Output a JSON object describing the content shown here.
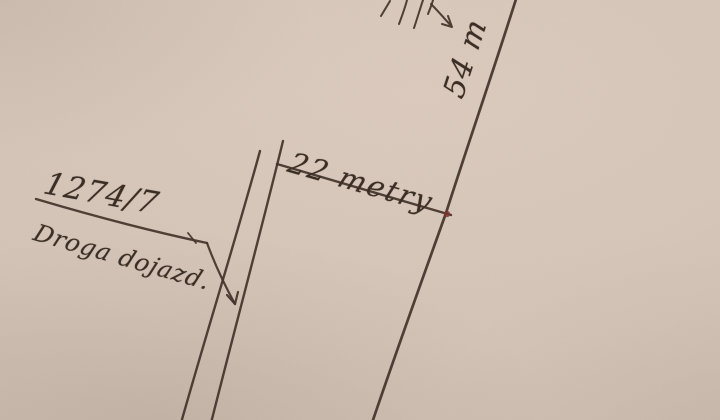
{
  "paper": {
    "background_color": "#d5c5b9",
    "ink_color": "#42332a"
  },
  "labels": {
    "plot_number": "1274/7",
    "road_name": "Droga dojazd.",
    "top_width_dimension": "22 metry",
    "side_length_dimension": "54 m"
  },
  "markers": {
    "junction_dot_color": "#7d352c"
  }
}
